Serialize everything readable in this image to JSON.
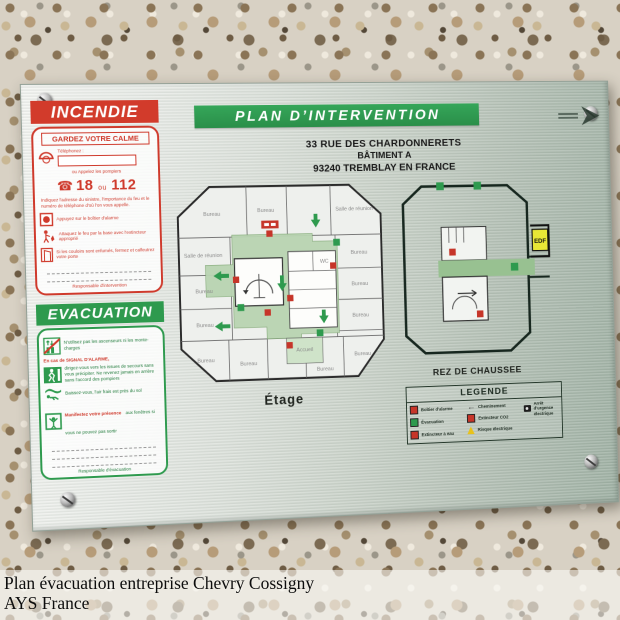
{
  "caption": {
    "line1": "Plan évacuation entreprise Chevry Cossigny",
    "line2": "AYS France"
  },
  "plate": {
    "title": "PLAN D’INTERVENTION",
    "address": {
      "line1": "33 RUE DES CHARDONNERETS",
      "line2": "BÂTIMENT A",
      "line3": "93240 TREMBLAY EN FRANCE"
    },
    "incendie": {
      "header": "INCENDIE",
      "calm": "GARDEZ VOTRE CALME",
      "tel_label": "Téléphonez :",
      "call_label": "ou Appelez les pompiers",
      "num1": "18",
      "ou": "ou",
      "num2": "112",
      "warn": "Indiquez l'adresse du sinistre, l'importance du feu et le numéro de téléphone d'où l'on vous appelle.",
      "step_alarm": "Appuyez sur le boîtier d'alarme",
      "step_fire": "Attaquez le feu par la base avec l'extincteur approprié",
      "step_door": "Si les couloirs sont enfumés, fermez et calfeutrez votre porte",
      "resp": "Responsable d'intervention"
    },
    "evacuation": {
      "header": "EVACUATION",
      "step_lift": "N'utilisez pas les ascenseurs ni les monte-charges",
      "alarm_red": "En cas de SIGNAL D'ALARME,",
      "step_exit": "dirigez-vous vers les issues de secours sans vous précipiter. Ne revenez jamais en arrière sans l'accord des pompiers",
      "step_crawl": "Baissez-vous, l'air frais est près du sol",
      "step_window_red": "Manifestez votre présence",
      "step_window_green": "aux fenêtres si vous ne pouvez pas sortir",
      "resp": "Responsable d'évacuation"
    },
    "etage": {
      "label": "Étage",
      "rooms": [
        "Bureau",
        "Bureau",
        "Salle de réunion",
        "Salle de réunion",
        "Bureau",
        "Bureau",
        "Bureau",
        "Bureau",
        "Bureau",
        "Bureau",
        "Bureau",
        "Accueil",
        "Bureau",
        "Bureau",
        "WC"
      ]
    },
    "rdc": {
      "label": "REZ DE CHAUSSEE",
      "edf": "EDF"
    },
    "legend": {
      "title": "LEGENDE",
      "items": [
        {
          "icon": "alarm-box",
          "label": "Boîtier d'alarme"
        },
        {
          "icon": "evacuation",
          "label": "Évacuation"
        },
        {
          "icon": "water-extinguisher",
          "label": "Extincteur à eau"
        },
        {
          "icon": "route",
          "label": "Cheminement"
        },
        {
          "icon": "co2-extinguisher",
          "label": "Extincteur CO2"
        },
        {
          "icon": "electric-risk",
          "label": "Risque électrique"
        },
        {
          "icon": "emergency-stop",
          "label": "Arrêt d'urgence électrique"
        }
      ]
    }
  },
  "colors": {
    "header_green": "#2e9a4e",
    "alert_red": "#cf3a2c",
    "plan_fill_green": "#b9d4b2",
    "corridor_green": "#98c191",
    "edf_yellow": "#e8e636",
    "plate_metal": "#cfd6cf"
  }
}
